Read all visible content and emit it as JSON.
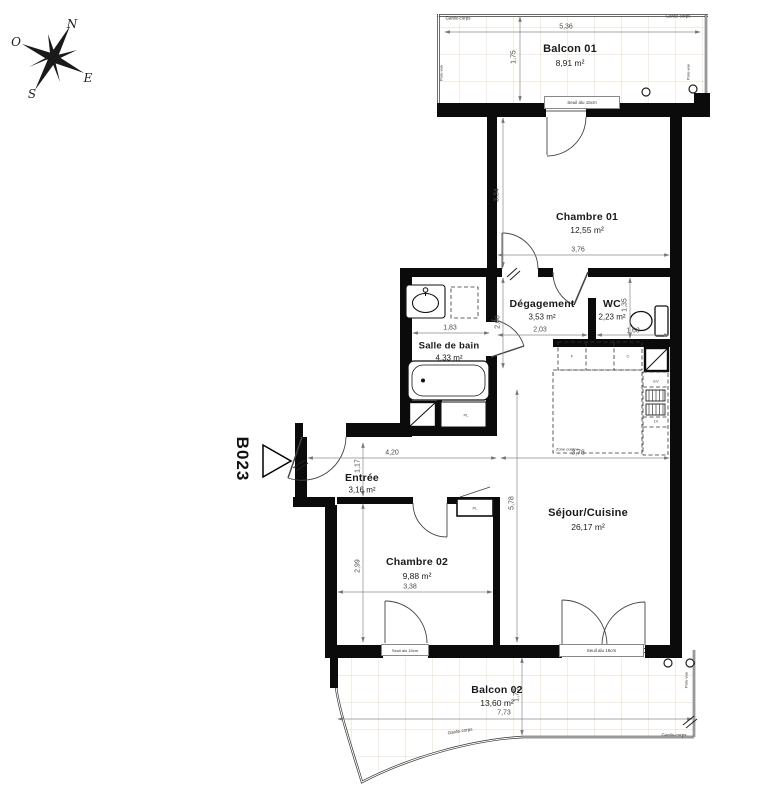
{
  "unit": {
    "label": "B023"
  },
  "compass": {
    "n": "N",
    "e": "E",
    "s": "S",
    "o": "O"
  },
  "rooms": {
    "balcon01": {
      "name": "Balcon 01",
      "area": "8,91 m²"
    },
    "chambre01": {
      "name": "Chambre 01",
      "area": "12,55 m²"
    },
    "degagement": {
      "name": "Dégagement",
      "area": "3,53 m²"
    },
    "wc": {
      "name": "WC",
      "area": "2,23 m²"
    },
    "sdb": {
      "name": "Salle de bain",
      "area": "4,33 m²"
    },
    "entree": {
      "name": "Entrée",
      "area": "3,16 m²"
    },
    "chambre02": {
      "name": "Chambre 02",
      "area": "9,88 m²"
    },
    "sejour": {
      "name": "Séjour/Cuisine",
      "area": "26,17 m²"
    },
    "balcon02": {
      "name": "Balcon 02",
      "area": "13,60 m²"
    }
  },
  "dims": {
    "balcon01_w": "5,36",
    "balcon01_d": "1,75",
    "ch01_d": "3,34",
    "ch01_w": "3,76",
    "deg_d": "2,00",
    "deg_w": "2,03",
    "wc_d": "1,35",
    "wc_w": "1,60",
    "sdb_w": "1,83",
    "entree_w": "4,20",
    "entree_d": "1,17",
    "sejour_w": "3,78",
    "sejour_d": "5,78",
    "ch02_d": "2,99",
    "ch02_w": "3,38",
    "balcon02_w": "7,73",
    "balcon02_d": "1,75"
  },
  "labels": {
    "garde_corps": "Garde-corps",
    "pare_vue": "Pare-vue",
    "seuil": "Seuil alu 15cm",
    "zone_cuisine": "Zone cuisine",
    "placard": "PL",
    "fridge": "F",
    "cook": "C",
    "sink": "EV",
    "dishwasher": "LV"
  }
}
